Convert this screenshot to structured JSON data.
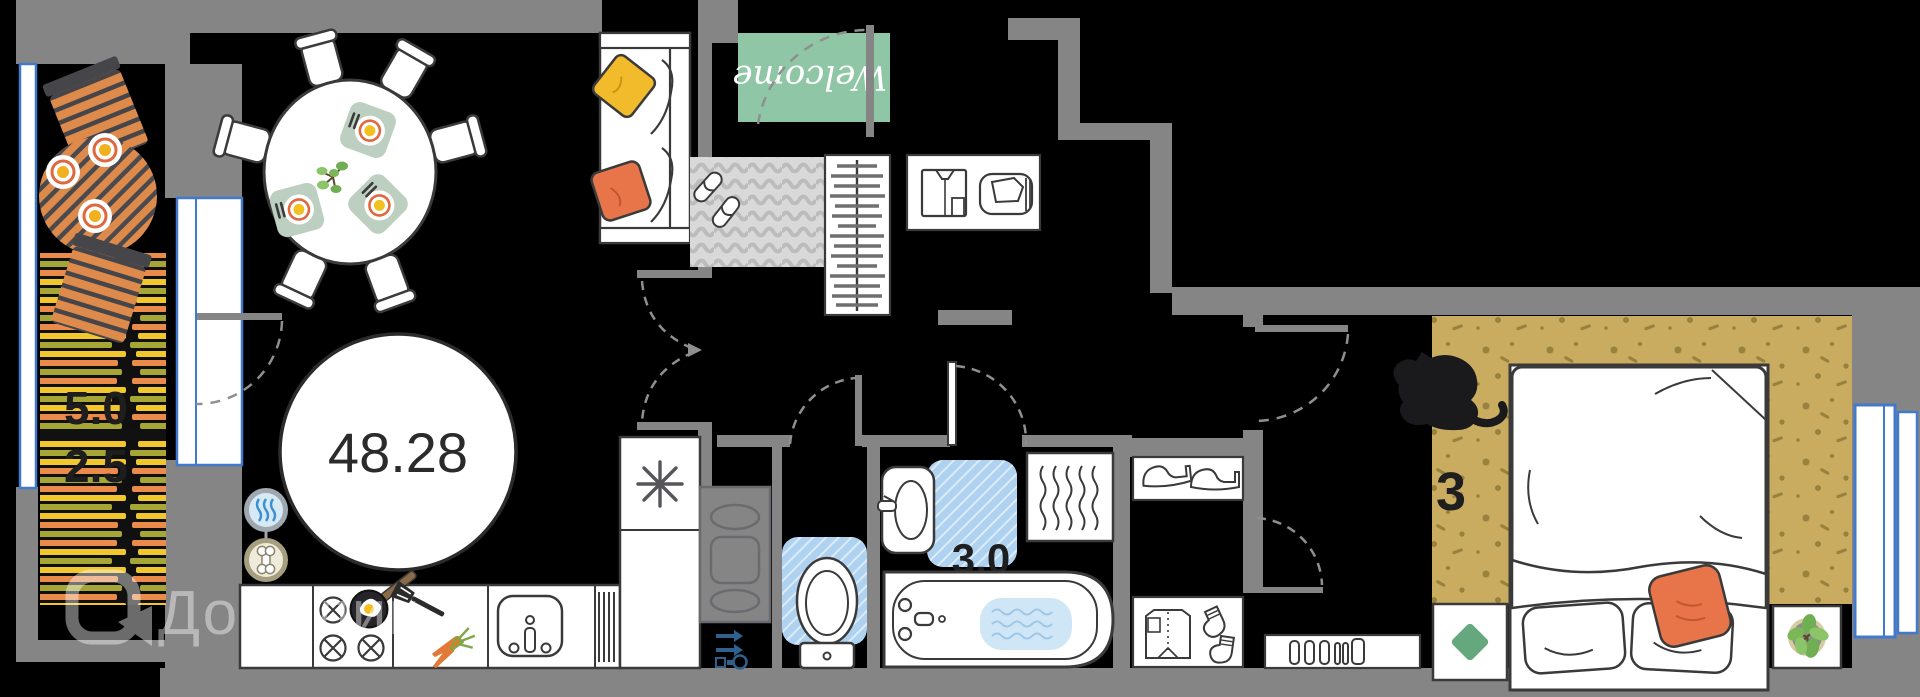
{
  "plan": {
    "labels": {
      "total_area": "48.28",
      "balcony_area_upper": "5.0",
      "balcony_area_lower": "2.5",
      "bathroom_area": "3.0",
      "bedroom_number": "3",
      "welcome_mat": "Welcome"
    },
    "watermark": {
      "brand": "Домклик"
    },
    "colors": {
      "background": "#000000",
      "wall_gray": "#858585",
      "outline_dark": "#3A3A3A",
      "window_blue": "#4379CC",
      "welcome_mat_green": "#8FC7A6",
      "bath_mat_blue": "#AFD2F0",
      "bedroom_carpet_tan": "#C9AC5F",
      "carpet_speckle": "#96813E",
      "balcony_furniture_orange": "#DE8A4B",
      "rug_stripe_orange": "#EA8B4C",
      "rug_stripe_yellow": "#F2C72E",
      "rug_stripe_olive": "#A6A637",
      "pillow_yellow": "#F2BB2C",
      "pillow_orange": "#E87549",
      "placemat_sage": "#BCCFC0",
      "plate_ring_orange": "#E0683F",
      "egg_yolk_yellow": "#F2C11F",
      "nightstand_green": "#66A87D",
      "utility_icon_blue": "#2E618C",
      "water_blue": "#CFE6F6",
      "entry_rug_gray": "#D9D9D9"
    },
    "icons": [
      "balcony-chair-icon",
      "balcony-table-icon",
      "striped-rug-icon",
      "dining-table-icon",
      "dining-chair-icon",
      "placemat-icon",
      "houseplant-icon",
      "area-circle-badge",
      "heating-waves-badge-icon",
      "pet-bone-badge-icon",
      "stove-burners-icon",
      "frying-pan-icon",
      "spatula-icon",
      "carrots-icon",
      "kitchen-sink-icon",
      "dish-rack-icon",
      "fridge-snowflake-icon",
      "sofa-icon",
      "welcome-mat",
      "door-swing-arc",
      "entry-rug-icon",
      "slippers-icon",
      "hanger-closet-icon",
      "shirt-icon",
      "bag-icon",
      "utility-shaft-icon",
      "cleaning-tools-icon",
      "toilet-icon",
      "bath-mat-icon",
      "wash-basin-icon",
      "towel-warmer-icon",
      "bathtub-icon",
      "heels-icon",
      "folded-shirt-icon",
      "socks-icon",
      "radiator-icon",
      "cat-icon",
      "bed-icon",
      "nightstand-icon",
      "plant-pot-icon",
      "window-icon",
      "domclick-logo-icon"
    ]
  }
}
